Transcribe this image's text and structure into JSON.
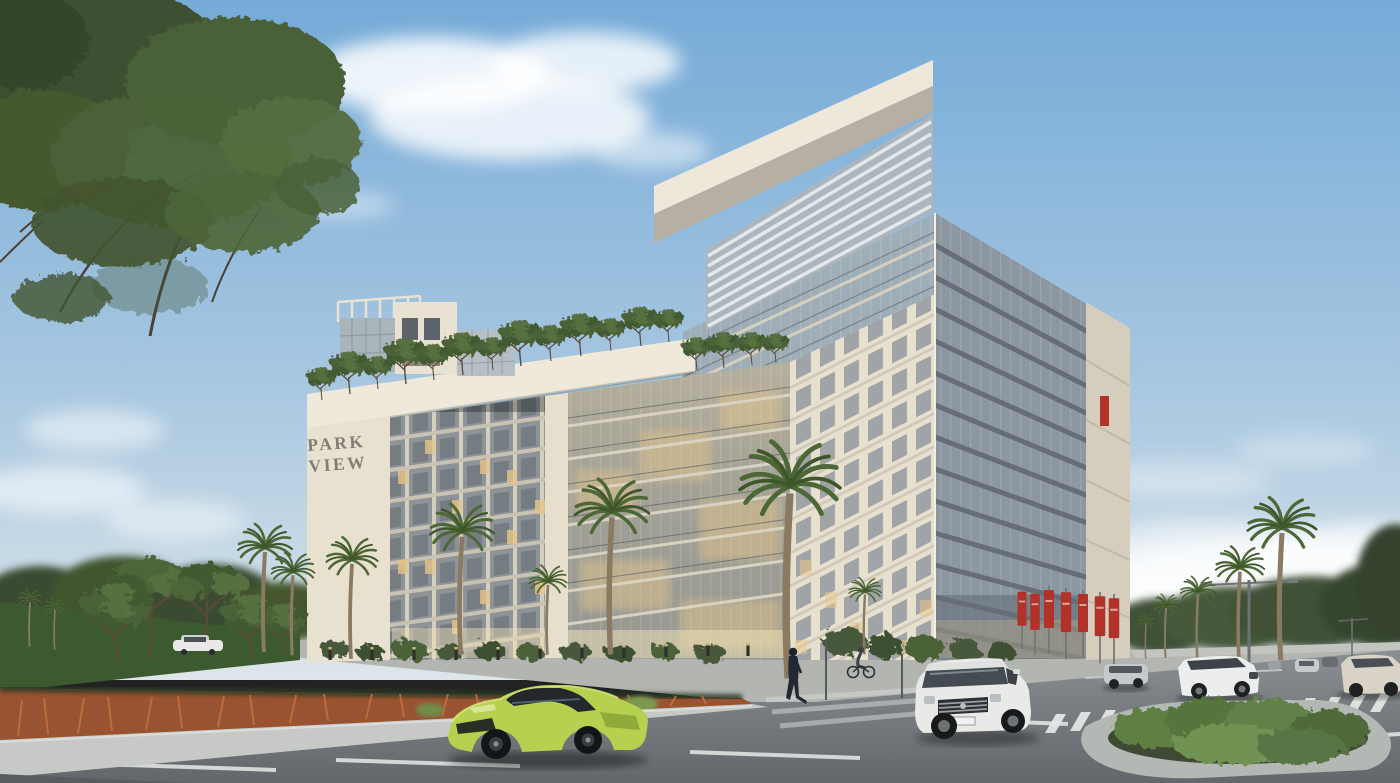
{
  "meta": {
    "scene": "architectural-rendering",
    "subject": "Park View residential building exterior street view",
    "canvas": {
      "width": 1400,
      "height": 783
    }
  },
  "signage": {
    "building_sign": {
      "line1": "PARK",
      "line2": "VIEW",
      "color": "#6e6d66"
    }
  },
  "palette": {
    "sky_top": "#76abd8",
    "sky_mid": "#a6c6e0",
    "sky_horizon": "#dde6ea",
    "cloud": "#ffffff",
    "facade_cream": "#e7e0cf",
    "facade_bright": "#efe9db",
    "facade_shadow": "#b5b0a3",
    "glass_blue": "#8d97a2",
    "glass_warm": "#c3b493",
    "window_lit": "#e8c88c",
    "banner_red": "#b23228",
    "foliage_dark": "#3e5132",
    "foliage_mid": "#4c6238",
    "foliage_light": "#5f7d46",
    "lawn_green": "#3c5a30",
    "grass_rust": "#9a5330",
    "road_grey": "#8b8f93",
    "road_dark": "#63676b",
    "sidewalk": "#c7c9c6",
    "marking_white": "#e8eae9"
  },
  "objects": {
    "buildings": [
      {
        "name": "park-view-tower",
        "features": [
          "cantilevered-roof-canopy",
          "louvered-sunshade",
          "glass-curtain-wall"
        ]
      },
      {
        "name": "park-view-podium",
        "features": [
          "portal-frame",
          "park-view-sign",
          "glass-atrium",
          "rooftop-garden",
          "penthouse"
        ]
      }
    ],
    "vehicles": [
      {
        "name": "lime-sports-car",
        "color": "#b5d14f"
      },
      {
        "name": "white-suv",
        "color": "#e9eae8"
      },
      {
        "name": "white-crossover",
        "color": "#eceded"
      },
      {
        "name": "silver-suv",
        "color": "#c6c9cb"
      },
      {
        "name": "beige-car",
        "color": "#d8d3c6"
      },
      {
        "name": "parked-white-car",
        "color": "#e9eae8"
      }
    ],
    "people": [
      {
        "name": "pedestrian-crossing"
      },
      {
        "name": "cyclist"
      }
    ],
    "street": {
      "red_banners": 7,
      "crosswalks": 2,
      "street_lamps": 2,
      "bollards": 11,
      "palm_trees": 14
    }
  }
}
